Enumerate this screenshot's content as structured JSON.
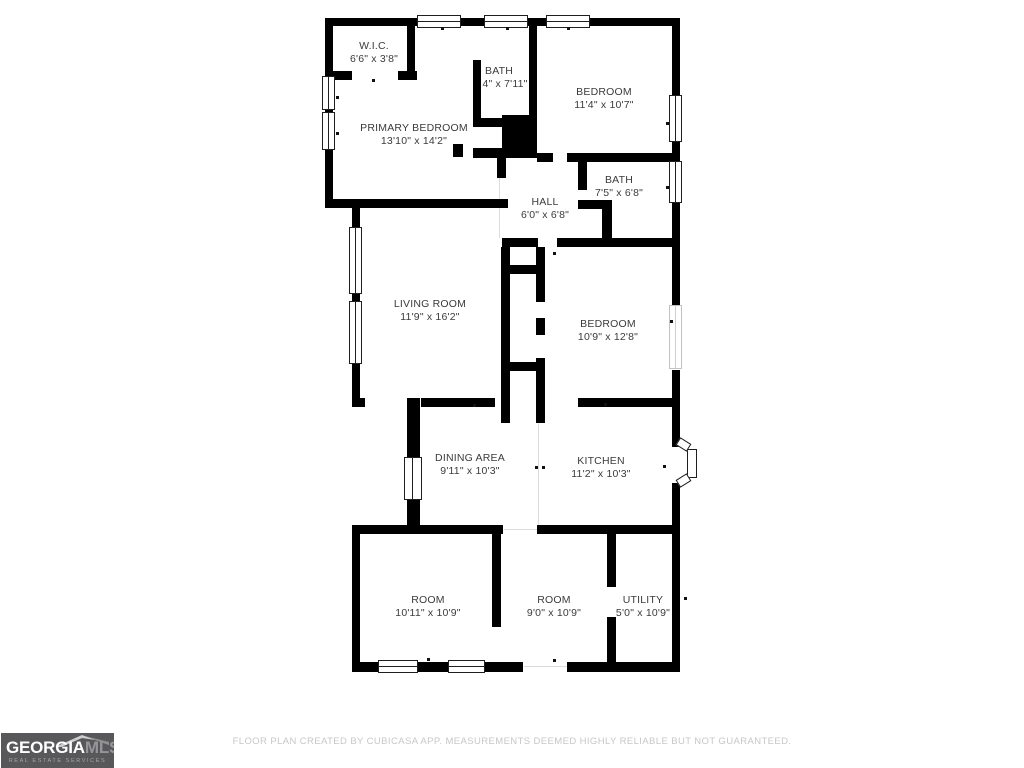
{
  "colors": {
    "wall": "#000000",
    "label": "#3b3b3b",
    "disclaimer": "#c7c7c7"
  },
  "floorplan": {
    "rooms": [
      {
        "name": "W.I.C.",
        "dims": "6'6\" x 3'8\"",
        "cx": 374,
        "y": 40
      },
      {
        "name": "PRIMARY BEDROOM",
        "dims": "13'10\" x 14'2\"",
        "cx": 414,
        "y": 122
      },
      {
        "name": "BATH",
        "dims": "4\" x 7'11\"",
        "cx": 499,
        "y": 65,
        "dcx": 505
      },
      {
        "name": "BEDROOM",
        "dims": "11'4\" x 10'7\"",
        "cx": 604,
        "y": 86
      },
      {
        "name": "BATH",
        "dims": "7'5\" x 6'8\"",
        "cx": 619,
        "y": 174
      },
      {
        "name": "HALL",
        "dims": "6'0\" x 6'8\"",
        "cx": 545,
        "y": 196
      },
      {
        "name": "LIVING ROOM",
        "dims": "11'9\" x 16'2\"",
        "cx": 430,
        "y": 298
      },
      {
        "name": "BEDROOM",
        "dims": "10'9\" x 12'8\"",
        "cx": 608,
        "y": 318
      },
      {
        "name": "DINING AREA",
        "dims": "9'11\" x 10'3\"",
        "cx": 470,
        "y": 452
      },
      {
        "name": "KITCHEN",
        "dims": "11'2\" x 10'3\"",
        "cx": 601,
        "y": 455
      },
      {
        "name": "ROOM",
        "dims": "10'11\" x 10'9\"",
        "cx": 428,
        "y": 594
      },
      {
        "name": "ROOM",
        "dims": "9'0\" x 10'9\"",
        "cx": 554,
        "y": 594
      },
      {
        "name": "UTILITY",
        "dims": "5'0\" x 10'9\"",
        "cx": 643,
        "y": 594
      }
    ],
    "walls": [
      [
        325,
        18,
        354,
        8
      ],
      [
        325,
        18,
        8,
        190
      ],
      [
        325,
        199,
        183,
        9
      ],
      [
        352,
        199,
        8,
        208
      ],
      [
        407,
        26,
        8,
        49
      ],
      [
        331,
        71,
        21,
        9
      ],
      [
        398,
        71,
        19,
        9
      ],
      [
        473,
        60,
        8,
        67
      ],
      [
        529,
        26,
        8,
        94
      ],
      [
        473,
        118,
        32,
        9
      ],
      [
        502,
        115,
        35,
        42
      ],
      [
        453,
        144,
        10,
        13
      ],
      [
        473,
        148,
        64,
        10
      ],
      [
        497,
        148,
        9,
        30
      ],
      [
        537,
        153,
        16,
        9
      ],
      [
        567,
        153,
        112,
        9
      ],
      [
        578,
        161,
        9,
        29
      ],
      [
        578,
        200,
        33,
        9
      ],
      [
        602,
        200,
        10,
        47
      ],
      [
        502,
        238,
        36,
        9
      ],
      [
        557,
        238,
        122,
        9
      ],
      [
        501,
        247,
        9,
        176
      ],
      [
        536,
        247,
        9,
        55
      ],
      [
        536,
        318,
        9,
        17
      ],
      [
        536,
        358,
        9,
        65
      ],
      [
        505,
        265,
        35,
        9
      ],
      [
        505,
        362,
        35,
        9
      ],
      [
        421,
        398,
        74,
        9
      ],
      [
        578,
        398,
        102,
        9
      ],
      [
        352,
        398,
        13,
        9
      ],
      [
        407,
        398,
        13,
        131
      ],
      [
        352,
        525,
        151,
        9
      ],
      [
        537,
        525,
        143,
        9
      ],
      [
        352,
        525,
        8,
        147
      ],
      [
        352,
        662,
        171,
        10
      ],
      [
        567,
        662,
        113,
        10
      ],
      [
        492,
        534,
        9,
        93
      ],
      [
        607,
        534,
        9,
        53
      ],
      [
        607,
        617,
        9,
        45
      ],
      [
        672,
        18,
        8,
        79
      ],
      [
        672,
        142,
        8,
        21
      ],
      [
        672,
        203,
        8,
        102
      ],
      [
        672,
        370,
        8,
        77
      ],
      [
        672,
        483,
        8,
        189
      ]
    ],
    "windows": [
      [
        417,
        15,
        44,
        13,
        "h"
      ],
      [
        484,
        15,
        44,
        13,
        "h"
      ],
      [
        546,
        15,
        44,
        13,
        "h"
      ],
      [
        322,
        76,
        13,
        34,
        "v"
      ],
      [
        322,
        112,
        13,
        38,
        "v"
      ],
      [
        349,
        227,
        13,
        67,
        "v"
      ],
      [
        349,
        301,
        13,
        63,
        "v"
      ],
      [
        669,
        95,
        13,
        47,
        "v"
      ],
      [
        669,
        161,
        13,
        42,
        "v"
      ],
      [
        669,
        305,
        13,
        64,
        "v",
        "light"
      ],
      [
        404,
        457,
        18,
        43,
        "v"
      ],
      [
        378,
        660,
        40,
        13,
        "h"
      ],
      [
        448,
        660,
        37,
        13,
        "h"
      ]
    ],
    "opening_lines": [
      [
        499,
        158,
        1,
        80
      ],
      [
        538,
        407,
        1,
        118
      ],
      [
        504,
        529,
        33,
        1
      ],
      [
        524,
        666,
        43,
        1
      ]
    ],
    "ticks": [
      [
        441,
        27
      ],
      [
        506,
        27
      ],
      [
        567,
        27
      ],
      [
        336,
        96
      ],
      [
        336,
        132
      ],
      [
        372,
        79
      ],
      [
        666,
        122
      ],
      [
        666,
        186
      ],
      [
        670,
        320
      ],
      [
        553,
        252
      ],
      [
        473,
        404
      ],
      [
        604,
        403
      ],
      [
        535,
        466
      ],
      [
        542,
        466
      ],
      [
        663,
        465
      ],
      [
        684,
        597
      ],
      [
        427,
        658
      ],
      [
        553,
        659
      ]
    ],
    "entry_door": {
      "leaf": [
        687,
        449,
        10,
        29
      ],
      "jambs": [
        [
          677,
          440,
          13,
          9,
          32
        ],
        [
          677,
          476,
          13,
          9,
          -32
        ]
      ]
    }
  },
  "footer": {
    "disclaimer": "FLOOR PLAN CREATED BY CUBICASA APP. MEASUREMENTS DEEMED HIGHLY RELIABLE BUT NOT GUARANTEED."
  },
  "logo": {
    "brand_primary": "GEORGIA",
    "brand_secondary": "MLS",
    "tagline": "REAL ESTATE SERVICES",
    "bg": "#58585a"
  }
}
